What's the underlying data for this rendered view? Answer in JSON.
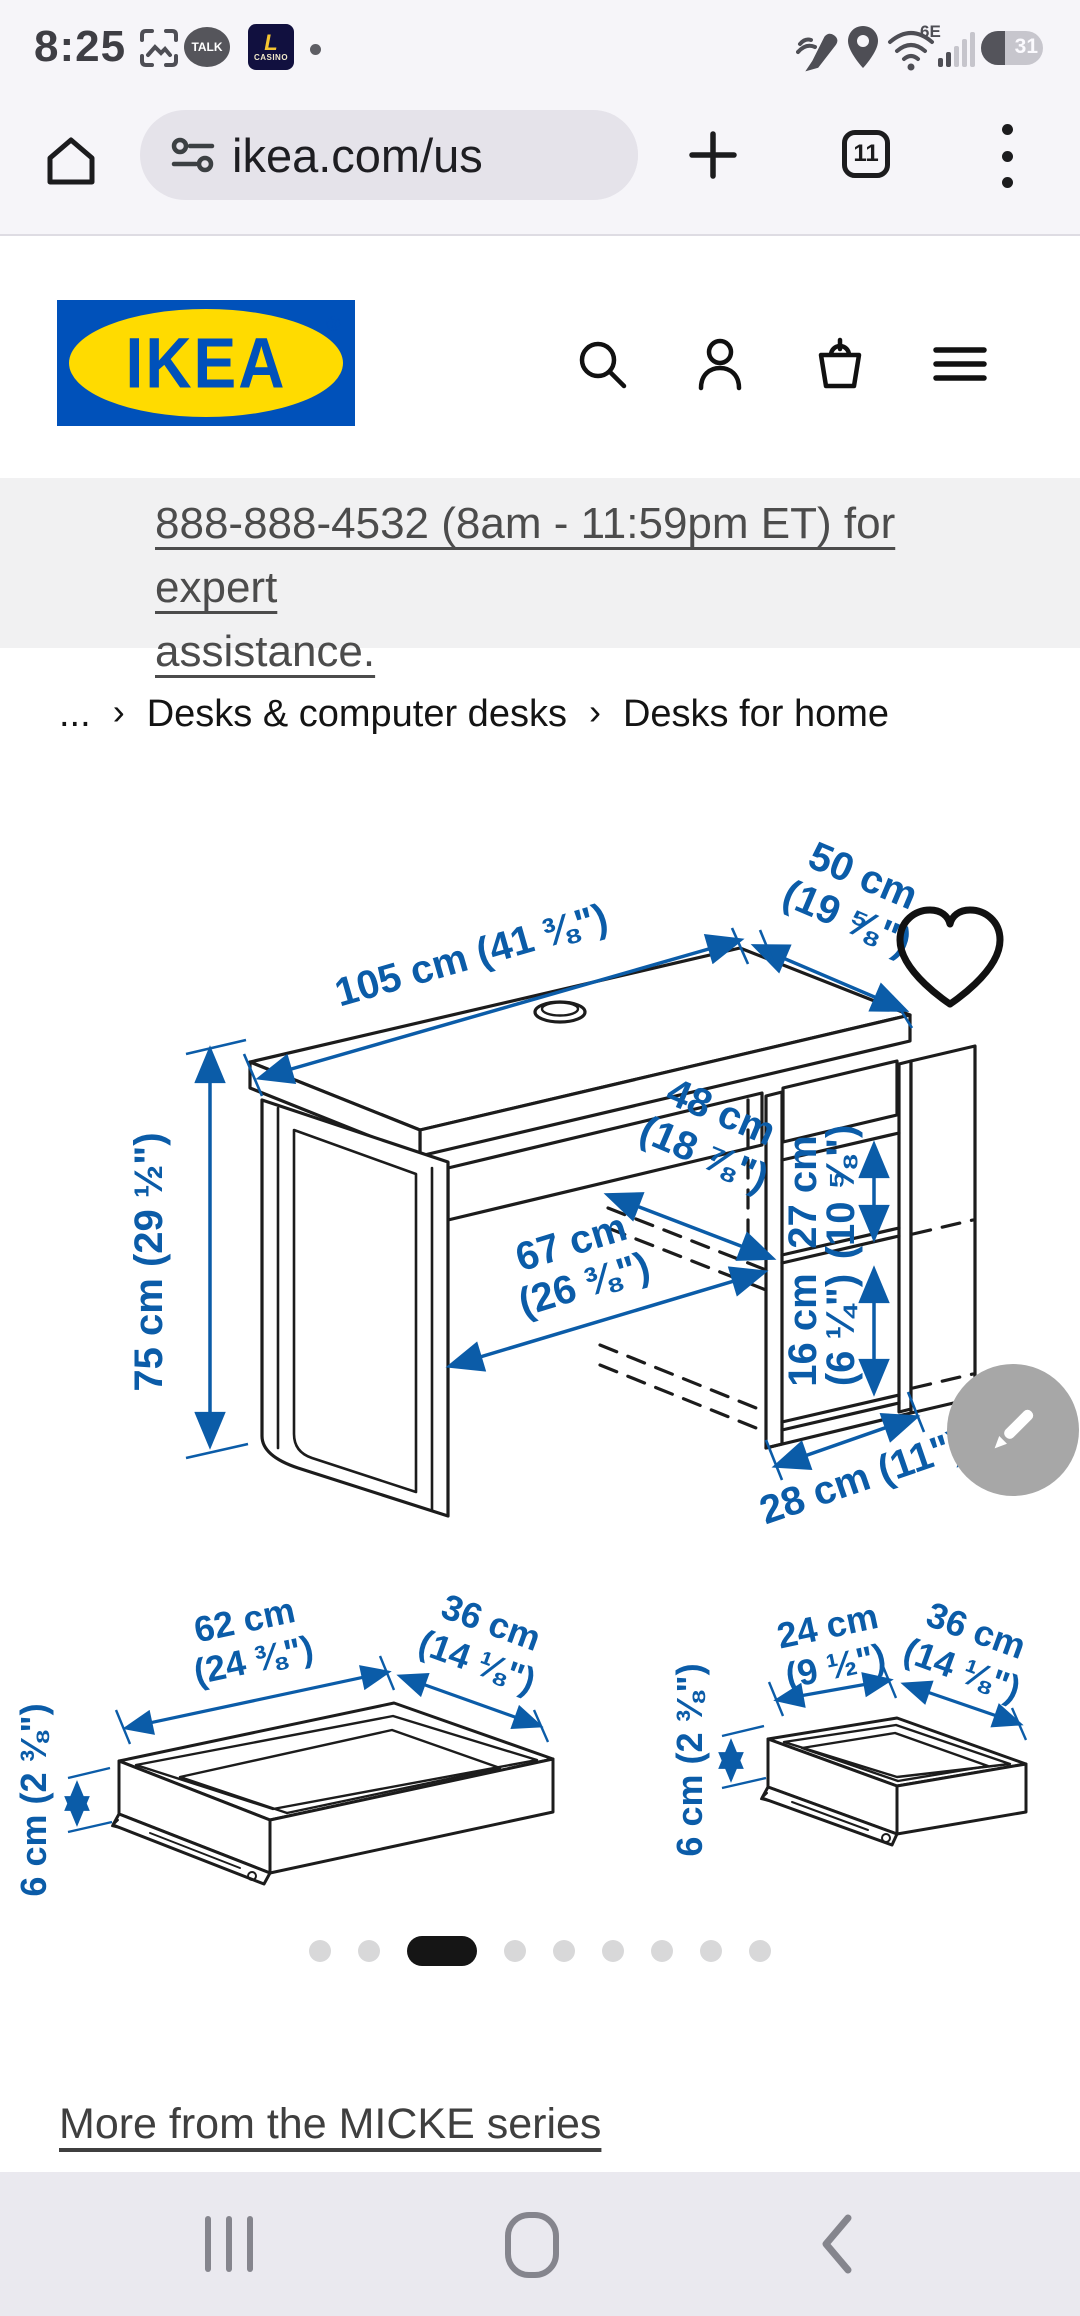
{
  "status_bar": {
    "time": "8:25",
    "talk_label": "TALK",
    "casino_letter": "L",
    "casino_label": "CASINO",
    "wifi_label": "6E",
    "battery_percent": "31"
  },
  "browser": {
    "url": "ikea.com/us",
    "tab_count": "11"
  },
  "site_header": {
    "logo_text": "IKEA",
    "logo_reg": "®"
  },
  "banner": {
    "line1": "888-888-4532 (8am - 11:59pm ET) for expert",
    "line2": "assistance."
  },
  "breadcrumb": {
    "ellipsis": "...",
    "separator": "›",
    "items": [
      "Desks & computer desks",
      "Desks for home"
    ]
  },
  "diagram": {
    "width": "105 cm (41 ⅜\")",
    "depth_l1": "50 cm",
    "depth_l2": "(19 ⅝\")",
    "height": "75 cm (29 ½\")",
    "inner_depth_l1": "48 cm",
    "inner_depth_l2": "(18 ⅞\")",
    "inner_width_l1": "67 cm",
    "inner_width_l2": "(26 ⅜\")",
    "shelf_upper_l1": "27 cm",
    "shelf_upper_l2": "(10 ⅝\")",
    "shelf_lower_l1": "16 cm",
    "shelf_lower_l2": "(6 ¼\")",
    "unit_width": "28 cm (11\")"
  },
  "drawer_large": {
    "width_l1": "62 cm",
    "width_l2": "(24 ⅜\")",
    "depth_l1": "36 cm",
    "depth_l2": "(14 ⅛\")",
    "height": "6 cm (2 ⅜\")"
  },
  "drawer_small": {
    "width_l1": "24 cm",
    "width_l2": "(9 ½\")",
    "depth_l1": "36 cm",
    "depth_l2": "(14 ⅛\")",
    "height": "6 cm (2 ⅜\")"
  },
  "more_link": {
    "label": "More from the MICKE series"
  },
  "colors": {
    "dimension_blue": "#0B5CA8",
    "ikea_blue": "#0051BA",
    "ikea_yellow": "#FFDB00"
  }
}
